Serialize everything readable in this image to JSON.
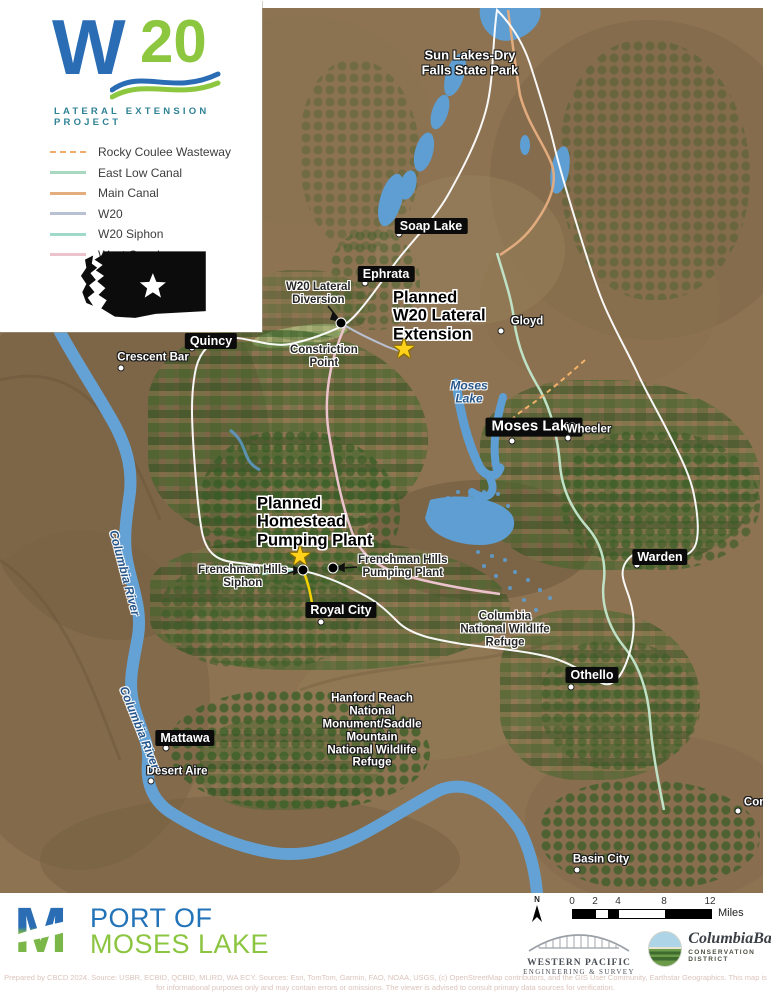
{
  "branding": {
    "logo_w": "W",
    "logo_20": "20",
    "subtitle": "LATERAL EXTENSION PROJECT",
    "colors": {
      "blue": "#2a6db5",
      "green": "#8dc63f",
      "teal": "#2f8296"
    }
  },
  "legend": {
    "items": [
      {
        "label": "Rocky Coulee Wasteway",
        "color": "#f0aa6a",
        "style": "dashed"
      },
      {
        "label": "East Low Canal",
        "color": "#a9d8c0",
        "style": "solid"
      },
      {
        "label": "Main Canal",
        "color": "#e3ad7e",
        "style": "solid"
      },
      {
        "label": "W20",
        "color": "#b9c0d2",
        "style": "solid"
      },
      {
        "label": "W20 Siphon",
        "color": "#9fd9c9",
        "style": "solid"
      },
      {
        "label": "West Canal",
        "color": "#ecc3cd",
        "style": "solid"
      }
    ]
  },
  "map": {
    "labels": [
      {
        "id": "sun-lakes-dry-falls",
        "type": "place-white",
        "lines": [
          "Sun Lakes-Dry",
          "Falls State Park"
        ],
        "x": 470,
        "y": 63,
        "size": 13
      },
      {
        "id": "soap-lake",
        "type": "city",
        "text": "Soap Lake",
        "x": 431,
        "y": 226,
        "dot": [
          399,
          234
        ]
      },
      {
        "id": "ephrata",
        "type": "city",
        "text": "Ephrata",
        "x": 386,
        "y": 274,
        "dot": [
          365,
          283
        ]
      },
      {
        "id": "w20-lateral-diversion",
        "type": "ann",
        "lines": [
          "W20 Lateral",
          "Diversion"
        ],
        "x": 286,
        "y": 294,
        "align": "left"
      },
      {
        "id": "planned-w20-lateral-extension",
        "type": "big",
        "lines": [
          "Planned",
          "W20 Lateral",
          "Extension"
        ],
        "x": 393,
        "y": 316,
        "align": "left"
      },
      {
        "id": "gloyd",
        "type": "place-white",
        "lines": [
          "Gloyd"
        ],
        "x": 527,
        "y": 322,
        "dot": [
          501,
          331
        ]
      },
      {
        "id": "quincy",
        "type": "city",
        "text": "Quincy",
        "x": 211,
        "y": 341,
        "dot": [
          192,
          348
        ]
      },
      {
        "id": "crescent-bar",
        "type": "place-white",
        "lines": [
          "Crescent Bar"
        ],
        "x": 153,
        "y": 358,
        "dot": [
          121,
          368
        ]
      },
      {
        "id": "constriction-point",
        "type": "ann",
        "lines": [
          "Constriction",
          "Point"
        ],
        "x": 290,
        "y": 357,
        "align": "left"
      },
      {
        "id": "moses-lake-water",
        "type": "water",
        "lines": [
          "Moses",
          "Lake"
        ],
        "x": 469,
        "y": 393
      },
      {
        "id": "moses-lake",
        "type": "city",
        "text": "Moses Lake",
        "x": 534,
        "y": 427,
        "dot": [
          512,
          441
        ],
        "big": true
      },
      {
        "id": "wheeler",
        "type": "place-white",
        "lines": [
          "Wheeler"
        ],
        "x": 589,
        "y": 430,
        "dot": [
          568,
          438
        ]
      },
      {
        "id": "planned-homestead-pumping-plant",
        "type": "big",
        "lines": [
          "Planned",
          "Homestead",
          "Pumping Plant"
        ],
        "x": 257,
        "y": 522,
        "align": "left"
      },
      {
        "id": "frenchman-hills-siphon",
        "type": "ann",
        "lines": [
          "Frenchman Hills",
          "Siphon"
        ],
        "x": 198,
        "y": 577,
        "align": "left"
      },
      {
        "id": "frenchman-hills-pumping-plant",
        "type": "ann",
        "lines": [
          "Frenchman Hills",
          "Pumping Plant"
        ],
        "x": 358,
        "y": 567,
        "align": "left"
      },
      {
        "id": "royal-city",
        "type": "city",
        "text": "Royal City",
        "x": 341,
        "y": 610,
        "dot": [
          321,
          622
        ]
      },
      {
        "id": "columbia-national-wildlife-refuge",
        "type": "ann",
        "lines": [
          "Columbia",
          "National Wildlife",
          "Refuge"
        ],
        "x": 505,
        "y": 630
      },
      {
        "id": "warden",
        "type": "city",
        "text": "Warden",
        "x": 660,
        "y": 557,
        "dot": [
          637,
          565
        ]
      },
      {
        "id": "othello",
        "type": "city",
        "text": "Othello",
        "x": 592,
        "y": 675,
        "dot": [
          571,
          687
        ]
      },
      {
        "id": "hanford-reach",
        "type": "place-white",
        "lines": [
          "Hanford Reach",
          "National",
          "Monument/Saddle",
          "Mountain",
          "National Wildlife",
          "Refuge"
        ],
        "x": 372,
        "y": 731
      },
      {
        "id": "mattawa",
        "type": "city",
        "text": "Mattawa",
        "x": 185,
        "y": 738,
        "dot": [
          166,
          748
        ]
      },
      {
        "id": "desert-aire",
        "type": "place-white",
        "lines": [
          "Desert Aire"
        ],
        "x": 177,
        "y": 772,
        "dot": [
          151,
          781
        ]
      },
      {
        "id": "basin-city",
        "type": "place-white",
        "lines": [
          "Basin City"
        ],
        "x": 601,
        "y": 860,
        "dot": [
          577,
          870
        ]
      },
      {
        "id": "connell",
        "type": "place-white",
        "lines": [
          "Connell"
        ],
        "x": 765,
        "y": 803,
        "dot": [
          738,
          811
        ]
      },
      {
        "id": "columbia-river-north",
        "type": "water",
        "lines": [
          "Columbia River"
        ],
        "x": 124,
        "y": 573,
        "rot": 75
      },
      {
        "id": "columbia-river-south",
        "type": "water",
        "lines": [
          "Columbia River"
        ],
        "x": 139,
        "y": 728,
        "rot": 68
      }
    ],
    "stars": [
      {
        "id": "planned-w20-lateral-extension-star",
        "x": 404,
        "y": 350
      },
      {
        "id": "planned-homestead-pumping-plant-star",
        "x": 300,
        "y": 557
      }
    ],
    "facility_dots": [
      {
        "id": "w20-lateral-diversion-point",
        "x": 341,
        "y": 323
      },
      {
        "id": "frenchman-hills-siphon-point",
        "x": 303,
        "y": 570
      },
      {
        "id": "frenchman-hills-pumping-plant-point",
        "x": 333,
        "y": 568
      }
    ]
  },
  "footer": {
    "port_logo": {
      "m": "M",
      "line1": "PORT OF",
      "line2": "MOSES LAKE"
    },
    "scalebar": {
      "north": "N",
      "unit": "Miles",
      "ticks": [
        {
          "label": "0",
          "mi": 0
        },
        {
          "label": "2",
          "mi": 2
        },
        {
          "label": "4",
          "mi": 4
        },
        {
          "label": "8",
          "mi": 8
        },
        {
          "label": "12",
          "mi": 12
        }
      ],
      "segments": [
        {
          "from": 0,
          "to": 2,
          "color": "#000000"
        },
        {
          "from": 2,
          "to": 3,
          "color": "#ffffff"
        },
        {
          "from": 3,
          "to": 4,
          "color": "#000000"
        },
        {
          "from": 4,
          "to": 8,
          "color": "#ffffff"
        },
        {
          "from": 8,
          "to": 12,
          "color": "#000000"
        }
      ]
    },
    "western_pacific": {
      "line1": "WESTERN PACIFIC",
      "line2": "ENGINEERING & SURVEY"
    },
    "columbia_basin": {
      "script": "ColumbiaBasin",
      "line2": "CONSERVATION DISTRICT"
    },
    "disclaimer_line1": "Prepared by CBCD 2024. Source: USBR, ECBID, QCBID, MLIRD, WA ECY. Sources: Esri, TomTom, Garmin, FAO, NOAA, USGS, (c) OpenStreetMap contributors, and the GIS User Community, Earthstar Geographics. This map is",
    "disclaimer_line2": "for informational purposes only and may contain errors or omissions. The viewer is advised to consult primary data sources for verification."
  }
}
